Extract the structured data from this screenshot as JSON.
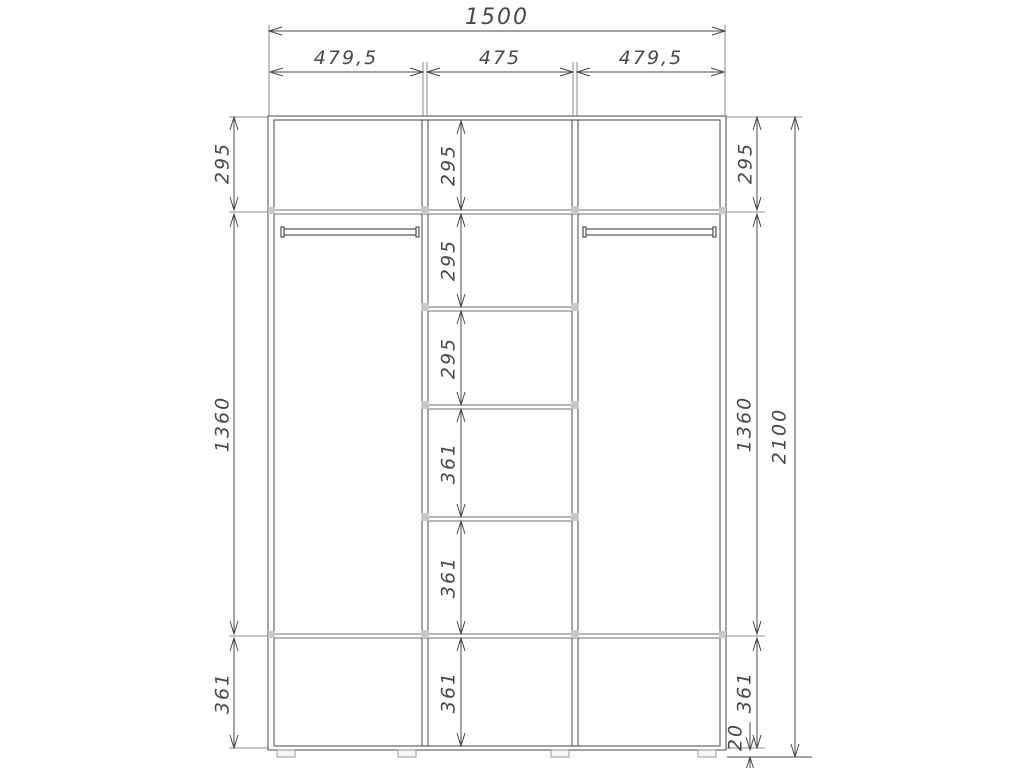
{
  "dimensions": {
    "overall_width": "1500",
    "overall_height": "2100",
    "plinth_height": "20",
    "section_widths": [
      "479,5",
      "475",
      "479,5"
    ],
    "left_column": [
      "295",
      "1360",
      "361"
    ],
    "center_column": [
      "295",
      "295",
      "295",
      "361",
      "361",
      "361"
    ],
    "right_column": [
      "295",
      "1360",
      "361"
    ]
  },
  "colors": {
    "line": "#4a4a4a",
    "structure": "#565656",
    "background": "#ffffff",
    "fitting_mark": "#c8c8c8"
  }
}
